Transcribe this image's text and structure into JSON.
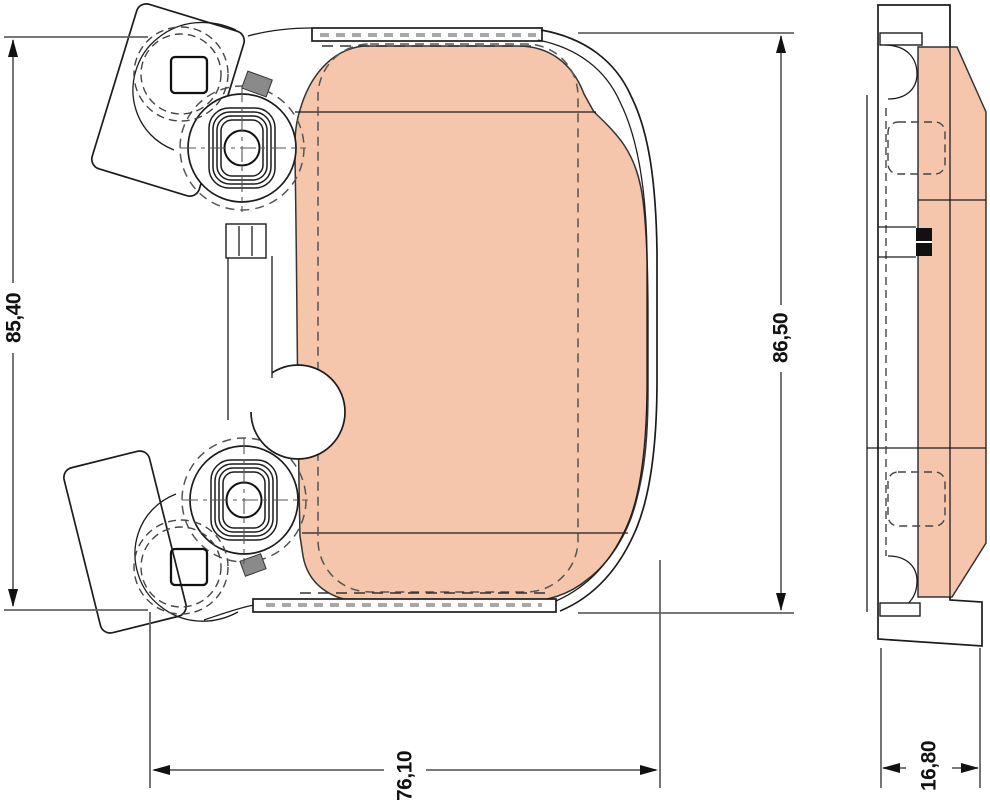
{
  "drawing": {
    "type": "brake-pad-technical-drawing",
    "background": "#ffffff",
    "line_color": "#1c1c1c",
    "dimension_line_color": "#666666",
    "friction_color": "#f5c6ab",
    "dimensions": {
      "left_height": "85,40",
      "pad_height": "86,50",
      "pad_width": "76,10",
      "pad_thickness": "16,80"
    }
  }
}
